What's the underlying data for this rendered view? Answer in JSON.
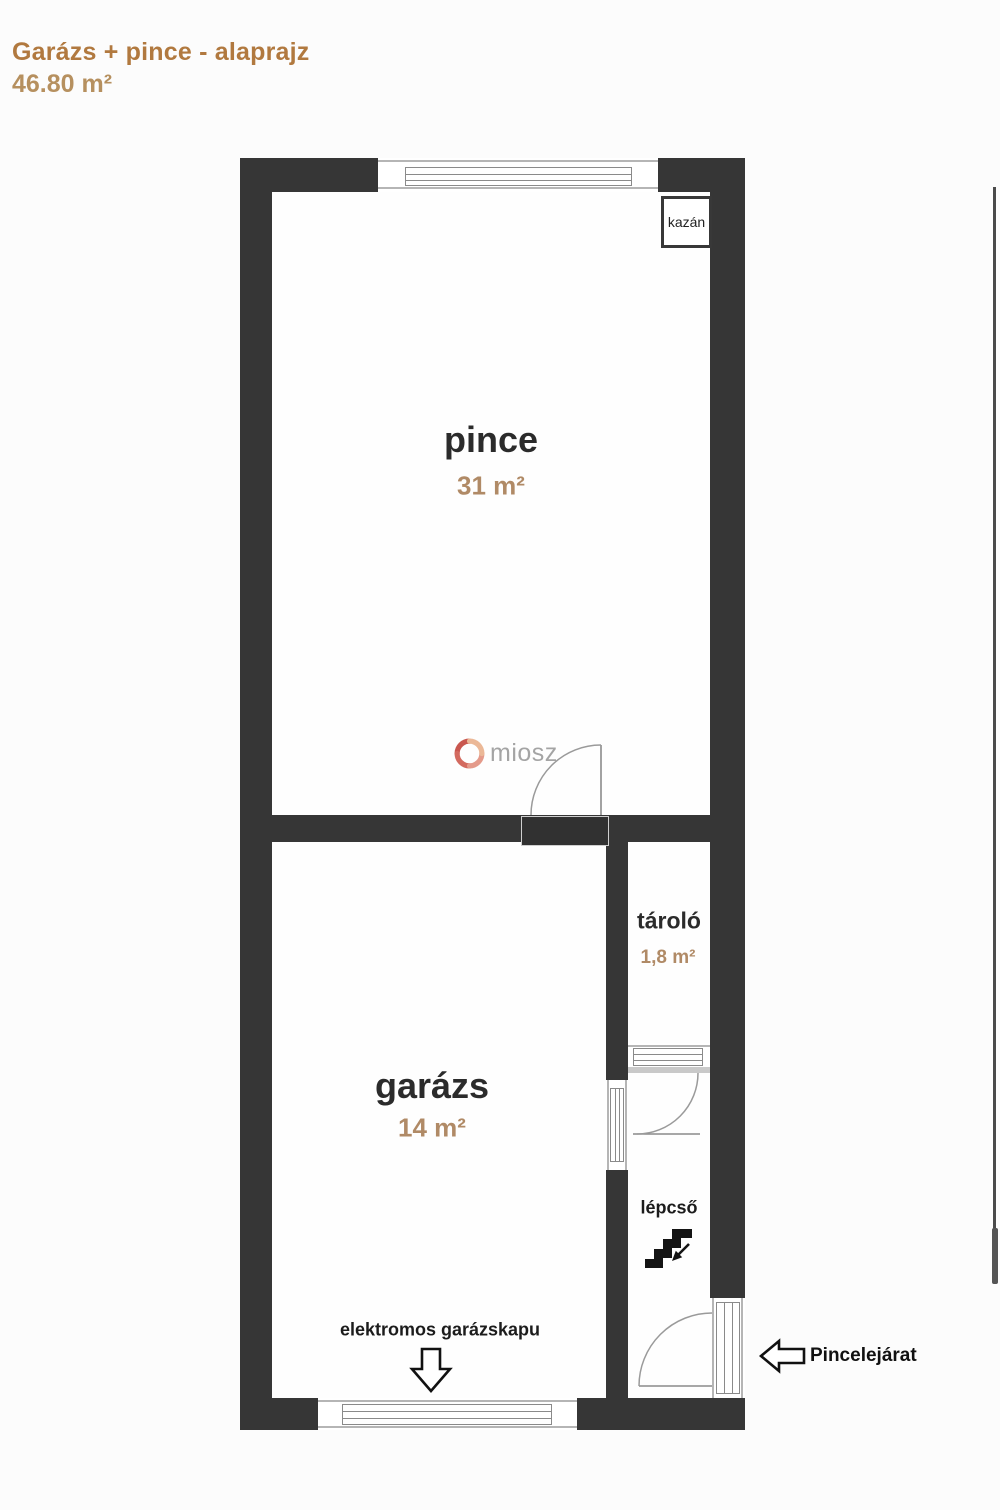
{
  "header": {
    "title": "Garázs + pince - alaprajz",
    "total_area": "46.80 m²"
  },
  "rooms": {
    "pince": {
      "name": "pince",
      "area": "31 m²"
    },
    "garazs": {
      "name": "garázs",
      "area": "14 m²"
    },
    "tarolo": {
      "name": "tároló",
      "area": "1,8 m²"
    },
    "lepcso": {
      "name": "lépcső"
    }
  },
  "annotations": {
    "kazan": "kazán",
    "garage_door": "elektromos garázskapu",
    "entrance": "Pincelejárat"
  },
  "watermark": {
    "text": "miosz"
  },
  "colors": {
    "title_accent": "#b1793f",
    "area_label": "#b08a66",
    "wall": "#363636",
    "logo_red": "#c4463d",
    "logo_salmon": "#e2907e",
    "logo_peach": "#eab18c"
  }
}
